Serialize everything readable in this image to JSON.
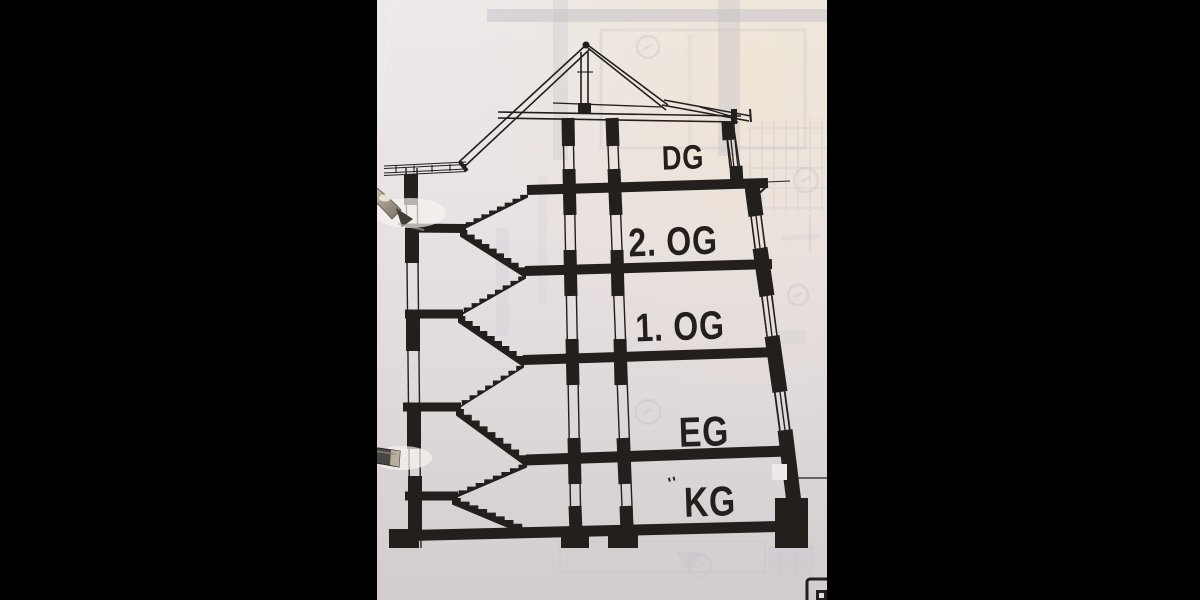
{
  "scene": {
    "floor_labels": [
      {
        "id": "dg",
        "text": "DG"
      },
      {
        "id": "og2",
        "text": "2. OG"
      },
      {
        "id": "og1",
        "text": "1. OG"
      },
      {
        "id": "eg",
        "text": "EG"
      },
      {
        "id": "kg",
        "text": "KG"
      }
    ],
    "kg_prefix_mark": "''",
    "colors": {
      "background": "#000000",
      "ink": "#221f1d",
      "paper_light": "#eeeaea",
      "paper_mid": "#e3dde0",
      "paper_dark": "#d2cccf",
      "bleed": "#c2c0c6",
      "glow": "#f6f3f0",
      "metal_light": "#efe9db",
      "metal_dark": "#6a6156"
    }
  }
}
